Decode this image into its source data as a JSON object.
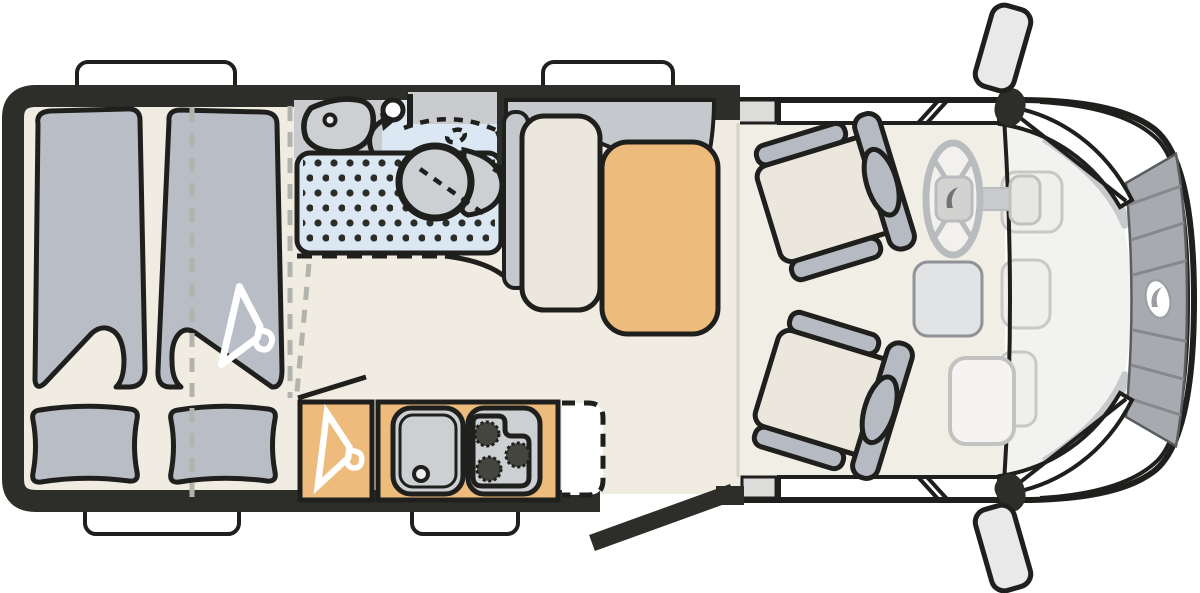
{
  "diagram": {
    "type": "motorhome-floorplan-top-view",
    "orientation": "cab-front-right",
    "areas": {
      "bedroom": {
        "items": [
          "bed-duvet-left",
          "bed-duvet-right",
          "pillow-left",
          "pillow-right",
          "bed-split-dashed-line",
          "clothes-hanger-icon"
        ]
      },
      "bathroom": {
        "items": [
          "washbasin",
          "faucet",
          "shower-tray-dotted",
          "swivel-toilet",
          "toilet-swivel-dashed-arc",
          "counter"
        ]
      },
      "kitchen": {
        "items": [
          "wardrobe-with-hanger-icon",
          "kitchen-sink",
          "three-burner-stove",
          "optional-unit-dashed"
        ]
      },
      "lounge": {
        "items": [
          "sideboard",
          "bench-seat",
          "dinette-table"
        ]
      },
      "cab": {
        "items": [
          "passenger-swivel-seat",
          "driver-swivel-seat",
          "steering-wheel",
          "center-console",
          "dashboard-tray",
          "wiper-left",
          "wiper-right",
          "grille",
          "brand-logo",
          "side-mirror-top",
          "side-mirror-bottom"
        ]
      },
      "shell": {
        "items": [
          "body-walls",
          "window-top-left",
          "window-top-middle",
          "window-bottom-left",
          "window-bottom-middle",
          "entry-door-open",
          "cab-door-window-top",
          "cab-door-window-bottom"
        ]
      }
    }
  },
  "colors": {
    "wall": "#2d2d29",
    "outline": "#1f1f1d",
    "floor": "#f0ece1",
    "cabFloor": "#f1eee6",
    "duvet": "#b9bdc6",
    "shower": "#dbe8f4",
    "showerDot": "#2c2c28",
    "fixture": "#cdd0d3",
    "bathGray": "#c9cbce",
    "wood": "#edbb7b",
    "seatCushion": "#ece7dd",
    "seatGray": "#b6bac2",
    "benchGray": "#c5c8cd",
    "white": "#ffffff",
    "hood": "#f2f2f0",
    "hoodDetail": "#efefec",
    "hoodLine": "#c8c8c6",
    "cowl": "#c7c9cb",
    "grille": "#a7aaae",
    "wheelGray": "#b9bcbf",
    "hub": "#d2d3d1",
    "mirror": "#e9e9e9",
    "console": "#e2e3e5",
    "dashTray": "#f5f4f1",
    "dashedGray": "#b3b3ae"
  }
}
